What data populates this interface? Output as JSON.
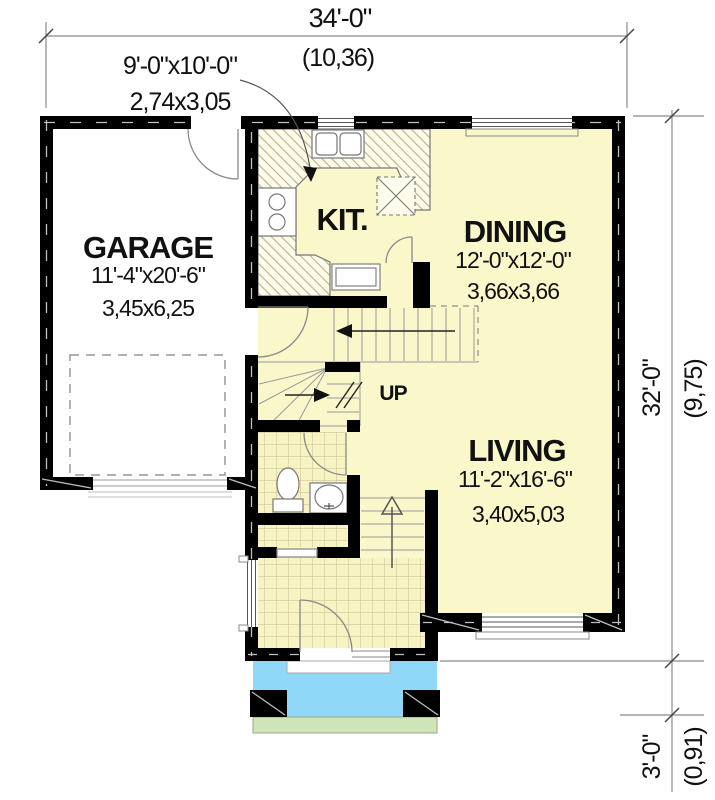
{
  "dimensions": {
    "overall_width": {
      "imperial": "34'-0\"",
      "metric": "(10,36)"
    },
    "overall_depth": {
      "imperial": "32'-0\"",
      "metric": "(9,75)"
    },
    "porch_depth": {
      "imperial": "3'-0\"",
      "metric": "(0,91)"
    }
  },
  "rooms": {
    "garage": {
      "label": "GARAGE",
      "size_imperial": "11'-4\"x20'-6\"",
      "size_metric": "3,45x6,25"
    },
    "kitchen": {
      "label": "KIT.",
      "size_imperial": "9'-0\"x10'-0\"",
      "size_metric": "2,74x3,05"
    },
    "dining": {
      "label": "DINING",
      "size_imperial": "12'-0\"x12'-0\"",
      "size_metric": "3,66x3,66"
    },
    "living": {
      "label": "LIVING",
      "size_imperial": "11'-2\"x16'-6\"",
      "size_metric": "3,40x5,03"
    }
  },
  "annotations": {
    "stair_direction": "UP"
  },
  "colors": {
    "wall": "#000000",
    "floor": "#faf7cb",
    "garage_floor": "#ffffff",
    "porch": "#8fd8f8",
    "lawn": "#cfe5b7",
    "dimension_line": "#8a8a8a",
    "text": "#111111"
  }
}
